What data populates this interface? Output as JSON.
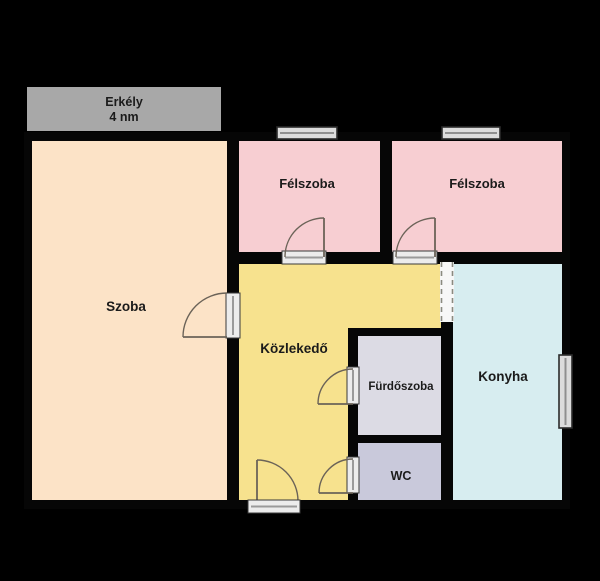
{
  "plan": {
    "type": "floor-plan",
    "rooms": {
      "erkely": {
        "label": "Erkély",
        "area": "4 nm"
      },
      "szoba": {
        "label": "Szoba"
      },
      "felszoba_left": {
        "label": "Félszoba"
      },
      "felszoba_right": {
        "label": "Félszoba"
      },
      "kozlekedo": {
        "label": "Közlekedő"
      },
      "furdoszoba": {
        "label": "Fürdőszoba"
      },
      "wc": {
        "label": "WC"
      },
      "konyha": {
        "label": "Konyha"
      }
    },
    "colors": {
      "background": "#000000",
      "balcony": "#a8a8a8",
      "szoba": "#fce3c7",
      "felszoba": "#f7ced2",
      "kozlekedo": "#f7e28e",
      "furdoszoba": "#dcdbe4",
      "wc": "#c9c9db",
      "konyha": "#d7edf0"
    }
  }
}
